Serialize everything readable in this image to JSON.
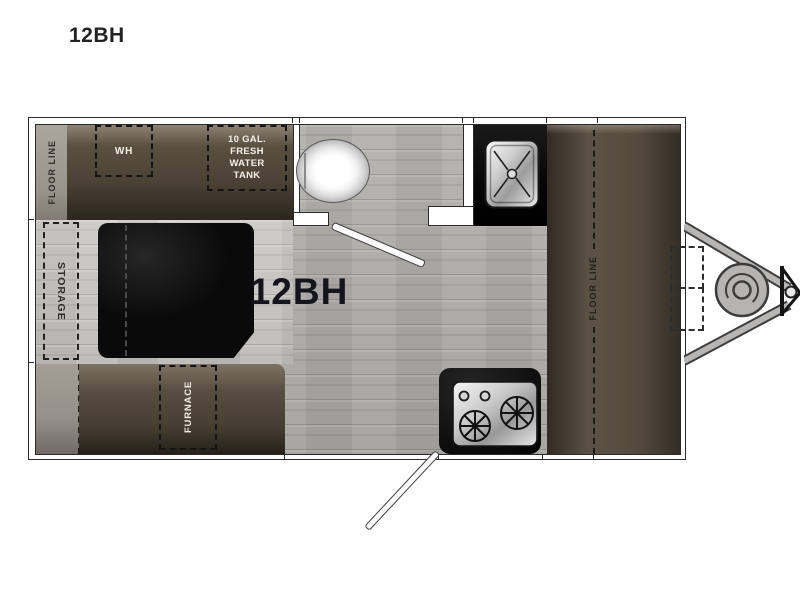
{
  "page": {
    "title": "12BH",
    "background": "#ffffff"
  },
  "floorplan": {
    "model_label": "12BH",
    "left_floor_line_label": "FLOOR LINE",
    "right_floor_line_label": "FLOOR LINE",
    "water_heater_label": "WH",
    "fresh_water_tank_label": [
      "10 GAL.",
      "FRESH",
      "WATER",
      "TANK"
    ],
    "storage_label": "STORAGE",
    "furnace_label": "FURNACE",
    "fixtures": [
      "toilet",
      "sink",
      "stove",
      "propane-tank",
      "hitch-coupler",
      "entry-door",
      "bathroom-door",
      "battery-box"
    ],
    "colors": {
      "cabinet_brown_dark": "#322b23",
      "cabinet_brown": "#54493c",
      "cabinet_brown_light": "#8d8274",
      "floor_wood": "#a9a7a3",
      "platform_wood": "#c6c4c0",
      "gray_strip": "#9b978f",
      "table_black": "#0d0d0d",
      "counter_black": "#111111",
      "metal_silver": "#d9d9d9",
      "tongue_gray": "#b5b4b2",
      "label_dark": "#2e2c27",
      "label_light": "#f3efe8"
    }
  }
}
